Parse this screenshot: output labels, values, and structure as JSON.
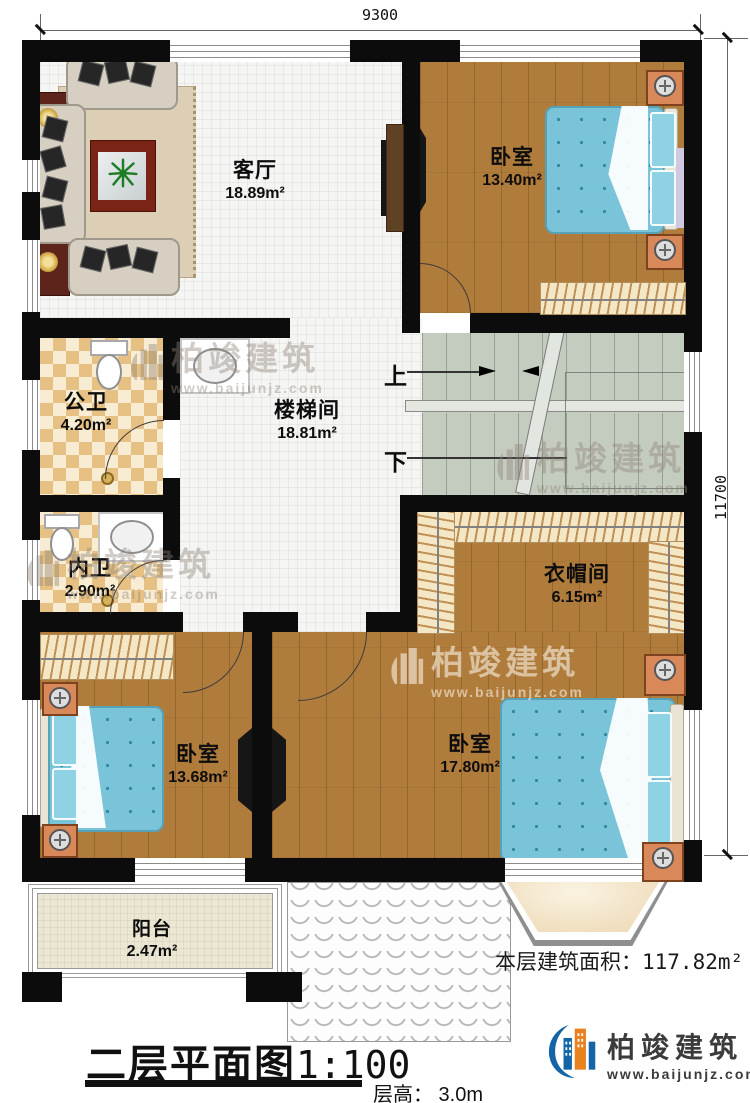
{
  "dimensions": {
    "width_mm": "9300",
    "height_mm": "11700"
  },
  "rooms": {
    "living": {
      "name": "客厅",
      "area": "18.89m²"
    },
    "bedroom_top": {
      "name": "卧室",
      "area": "13.40m²"
    },
    "public_bath": {
      "name": "公卫",
      "area": "4.20m²"
    },
    "stair_hall": {
      "name": "楼梯间",
      "area": "18.81m²"
    },
    "inner_bath": {
      "name": "内卫",
      "area": "2.90m²"
    },
    "cloakroom": {
      "name": "衣帽间",
      "area": "6.15m²"
    },
    "bedroom_left": {
      "name": "卧室",
      "area": "13.68m²"
    },
    "bedroom_right": {
      "name": "卧室",
      "area": "17.80m²"
    },
    "balcony": {
      "name": "阳台",
      "area": "2.47m²"
    }
  },
  "stairs": {
    "up_label": "上",
    "down_label": "下"
  },
  "annotations": {
    "floor_area_label": "本层建筑面积：",
    "floor_area_value": "117.82m²",
    "plan_title": "二层平面图",
    "plan_scale": "1:100",
    "floor_height": "层高： 3.0m"
  },
  "watermark": {
    "brand": "柏竣建筑",
    "site": "www.baijunjz.com"
  },
  "logo": {
    "brand": "柏竣建筑",
    "site": "www.baijunjz.com"
  },
  "colors": {
    "wall": "#0c0c0c",
    "wood": "#b07c3c",
    "bed_blue": "#7ac4da",
    "stair_sage": "#c4ccc0",
    "checker_tan": "#e6c183",
    "nightstand_orange": "#d9885a",
    "logo_blue": "#1465a8",
    "logo_orange": "#e8821e",
    "logo_text": "#3b3b3b"
  }
}
